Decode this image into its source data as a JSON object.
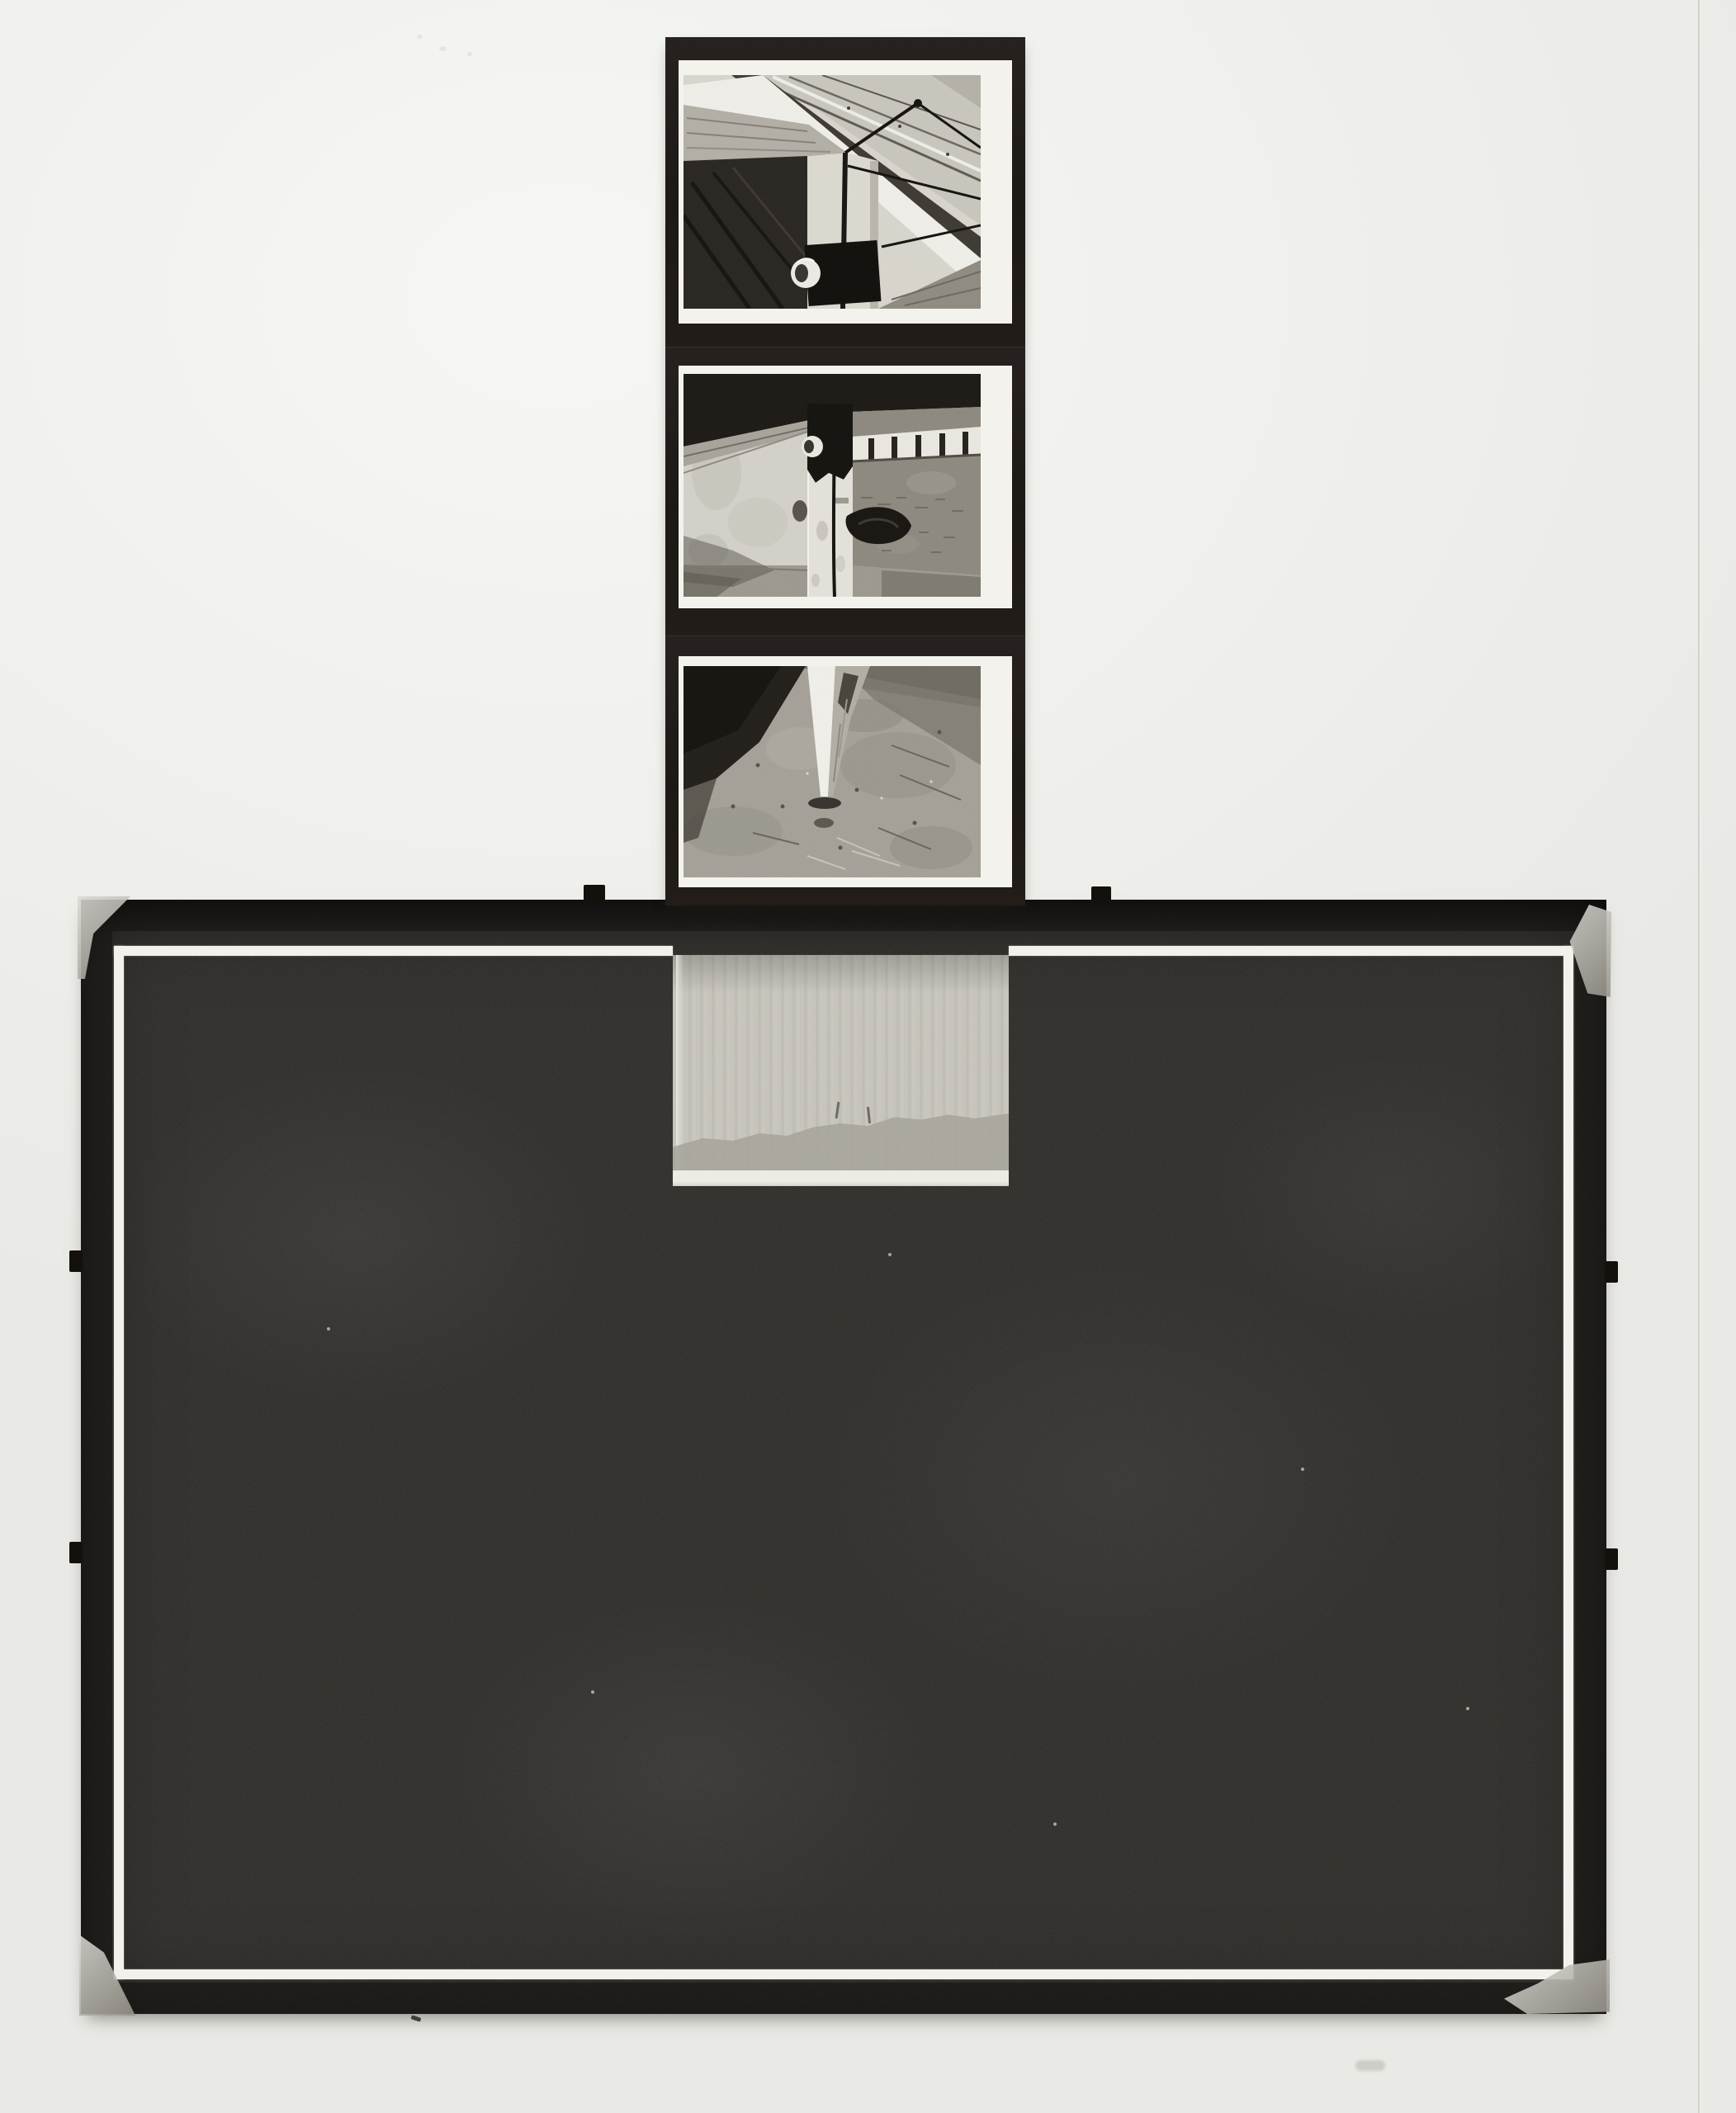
{
  "scene": {
    "description": "Black-and-white photograph of an artwork installation on a pale gallery wall: three framed black-and-white photographs of a whitewashed wooden post inside an empty industrial hall are stacked in a vertical column, resting on top of a large dark charcoal panel. The panel has a thin white border line drawn just inside its edges and a pale grey rectangular notch at its top centre that ends in a bright white sill.",
    "wall": {
      "color": "#f0f0ed",
      "seam_color": "#8c8a82",
      "marks": [
        "faint-specks-top-left",
        "small-nail-below-panel",
        "grey-smudge-below-panel-right"
      ]
    },
    "photo_stack": {
      "description": "Vertical column of three identically framed photographs following one wooden post from ceiling to floor.",
      "frame_color": "#1f1b17",
      "mat_color": "#f3f2ed",
      "photos": [
        {
          "name": "photo-ceiling-junction",
          "description": "View up the whitewashed post to the ceiling: diagonal roof boards, a heavy timber beam, a dark junction box with a white ceramic insulator, and wires running off to the right."
        },
        {
          "name": "photo-post-in-hall",
          "description": "The whitewashed post standing in an empty hall: dark ceiling band above, brick wall with a horizontal strip of windows at right, a dark hook-like object fixed to the post, a thin wire running down its face."
        },
        {
          "name": "photo-post-base",
          "description": "The tapering base of the post on a mottled concrete floor, with a large diagonal shadow falling across the upper left."
        }
      ]
    },
    "panel": {
      "description": "Wide dark charcoal panel, almost black, with a thin white border line inset from its edges; at top centre a pale grey washed notch interrupts the border line and ends in a white sill; light metal corner pieces show at the four corners and small dark mounting tabs protrude from the edges.",
      "base_color": "#2b2926",
      "edge_color": "#1b1815",
      "border_line_color": "#f2f1ec",
      "notch": {
        "wash_color": "#c7c4bc",
        "ridge_band_color": "#a7a399",
        "sill_color": "#f0efe9"
      },
      "corner_bracket_color": "#b9b7b0",
      "mounting_tab_color": "#14110c",
      "mounting_tab_count": 6,
      "corner_bracket_count": 4
    }
  }
}
